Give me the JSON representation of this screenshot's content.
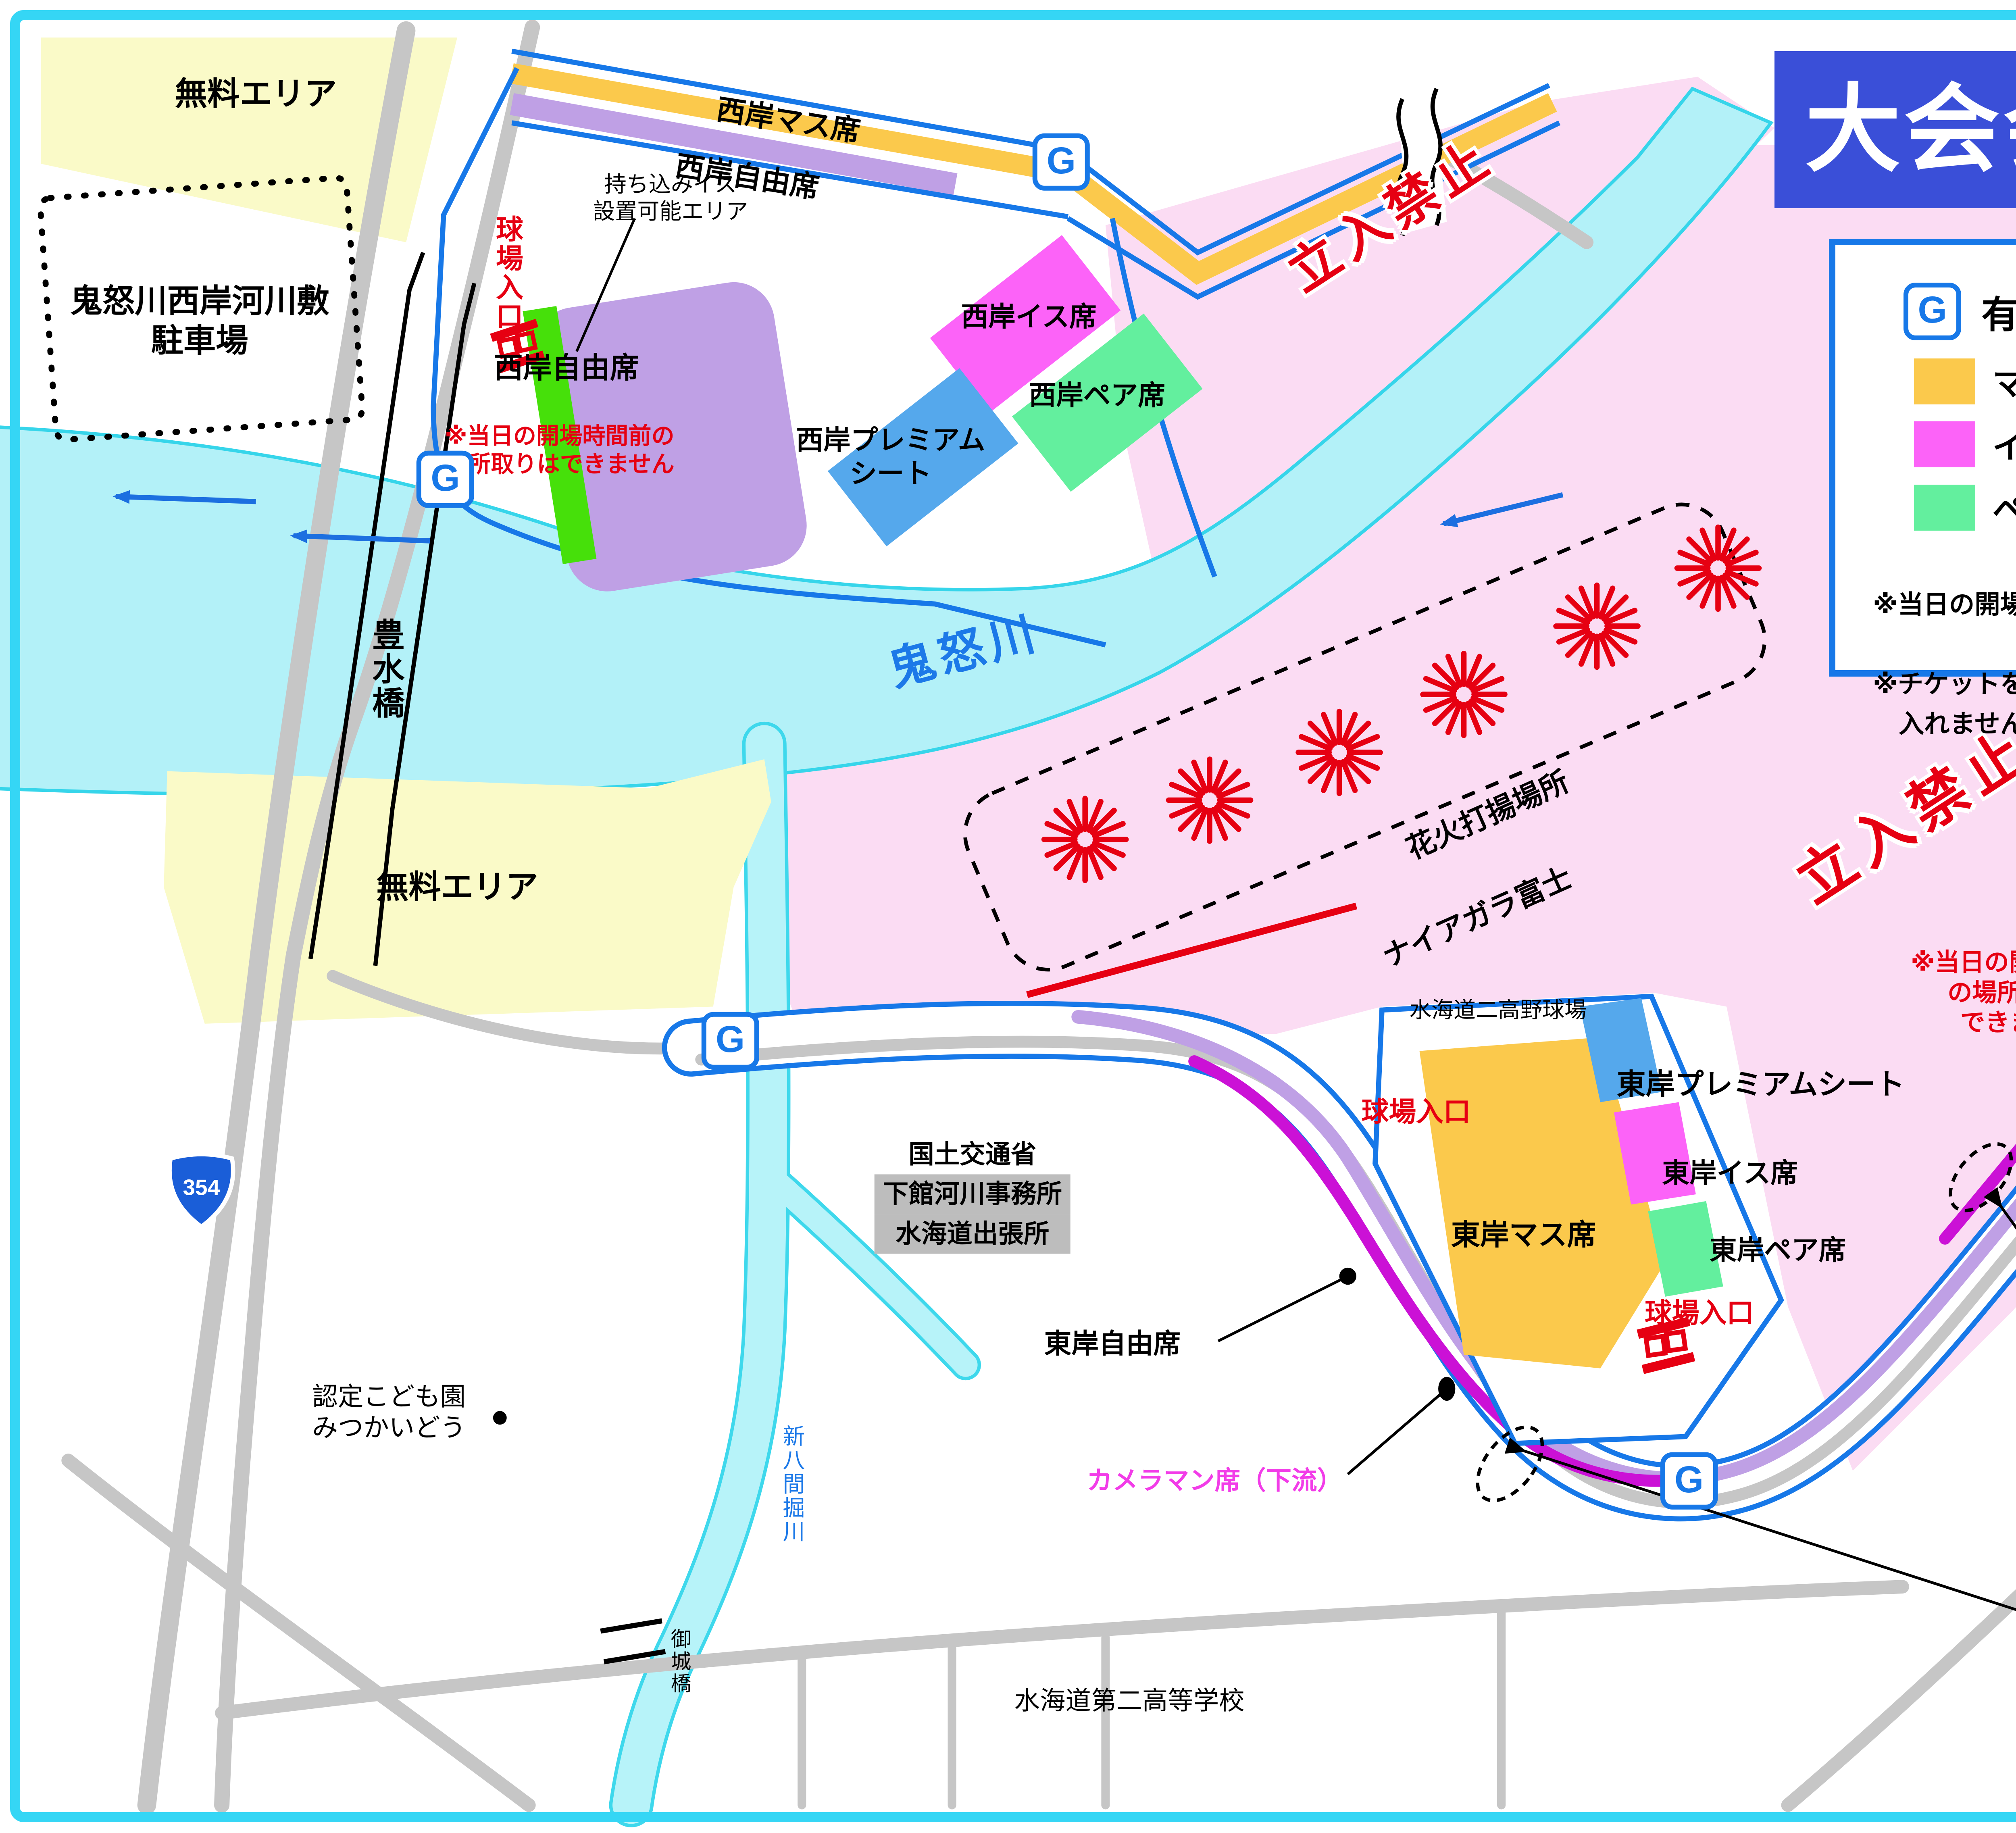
{
  "title": "大会会場周辺地図",
  "legend": {
    "header": "有料観覧席エリア",
    "entrance": {
      "icon": "G",
      "label": "有料観覧席入口",
      "time": "開場時間14：00"
    },
    "items": [
      {
        "label": "マス席",
        "color": "#FBC94C"
      },
      {
        "label": "プレミアムシート",
        "color": "#55A8EC"
      },
      {
        "label": "イス席",
        "color": "#FC63F8"
      },
      {
        "label": "自由席",
        "color": "#BBA4E0"
      },
      {
        "label": "ペア席",
        "color": "#63EF9E"
      },
      {
        "label": "カメラマン席",
        "color": "#C614D6"
      }
    ],
    "notes": [
      "※当日の開場時間前の場所取りはできません",
      "※チケットを持っている方以外はエリア内に\n　入れません"
    ]
  },
  "map": {
    "entrance_icon": "G",
    "areas": {
      "free_area_nw": "無料エリア",
      "free_area_w": "無料エリア",
      "parking": "鬼怒川西岸河川敷\n駐車場",
      "no_entry": "立入禁止",
      "fireworks_site": "花火打揚場所",
      "niagara": "ナイアガラ富士"
    },
    "west": {
      "mass": "西岸マス席",
      "free_strip": "西岸自由席",
      "free_block": "西岸自由席",
      "chair": "西岸イス席",
      "premium": "西岸プレミアム\nシート",
      "pair": "西岸ペア席",
      "bring_chair": "持ち込みイス\n設置可能エリア",
      "note": "※当日の開場時間前の\n場所取りはできません"
    },
    "east": {
      "ballpark": "水海道二高野球場",
      "mass": "東岸マス席",
      "premium": "東岸プレミアムシート",
      "chair": "東岸イス席",
      "pair": "東岸ペア席",
      "free": "東岸自由席",
      "cameraman_up": "カメラマン席（上流）",
      "cameraman_down": "カメラマン席（下流）",
      "note": "※当日の開場時間前\nの場所取りは\nできません"
    },
    "entrances": {
      "stadium": "球場入口"
    },
    "rivers": {
      "kinugawa": "鬼怒川",
      "shin_hachiken": "新八間掘川"
    },
    "bridges": {
      "hosui": "豊水橋",
      "goshiro": "御城橋"
    },
    "roads": {
      "route354": "354"
    },
    "places": {
      "kodomoen": "認定こども園\nみつかいどう",
      "mlit_l1": "国土交通省",
      "mlit_l2": "下館河川事務所",
      "mlit_l3": "水海道出張所",
      "school": "水海道第二高等学校"
    },
    "compass": "N",
    "inset": {
      "cameraman": "カメラマン席",
      "east_free": "東岸自由席",
      "levee": "堤防",
      "slope": "法面"
    }
  }
}
